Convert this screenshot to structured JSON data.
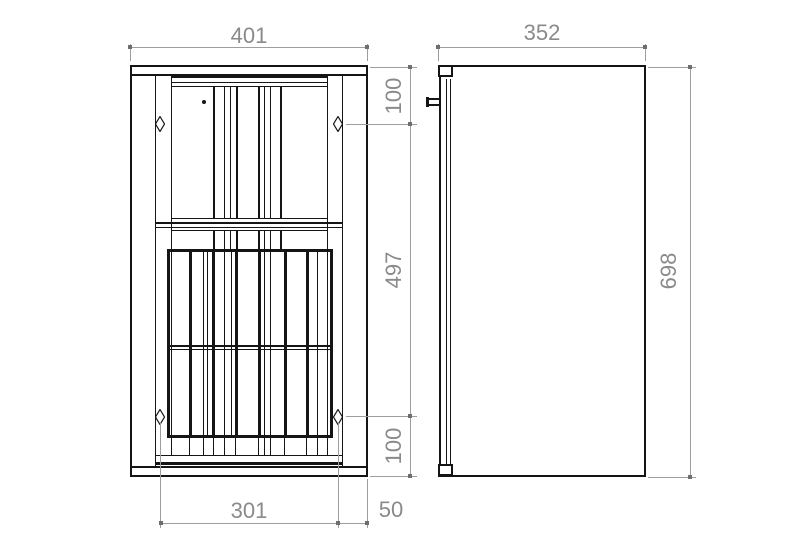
{
  "colors": {
    "line": "#151515",
    "dimension_line": "#9e9e9e",
    "dimension_text": "#8a8a8a",
    "background": "#ffffff"
  },
  "dims": {
    "front_width": "401",
    "side_depth": "352",
    "side_height": "698",
    "mount_top_offset": "100",
    "mount_vertical_span": "497",
    "mount_bottom_offset": "100",
    "mount_horizontal_span": "301",
    "mount_edge_offset": "50"
  },
  "markers": {
    "mount_hole": "diamond-marker",
    "door_knob": "dot-marker",
    "wall_hook": "bracket-marker"
  }
}
